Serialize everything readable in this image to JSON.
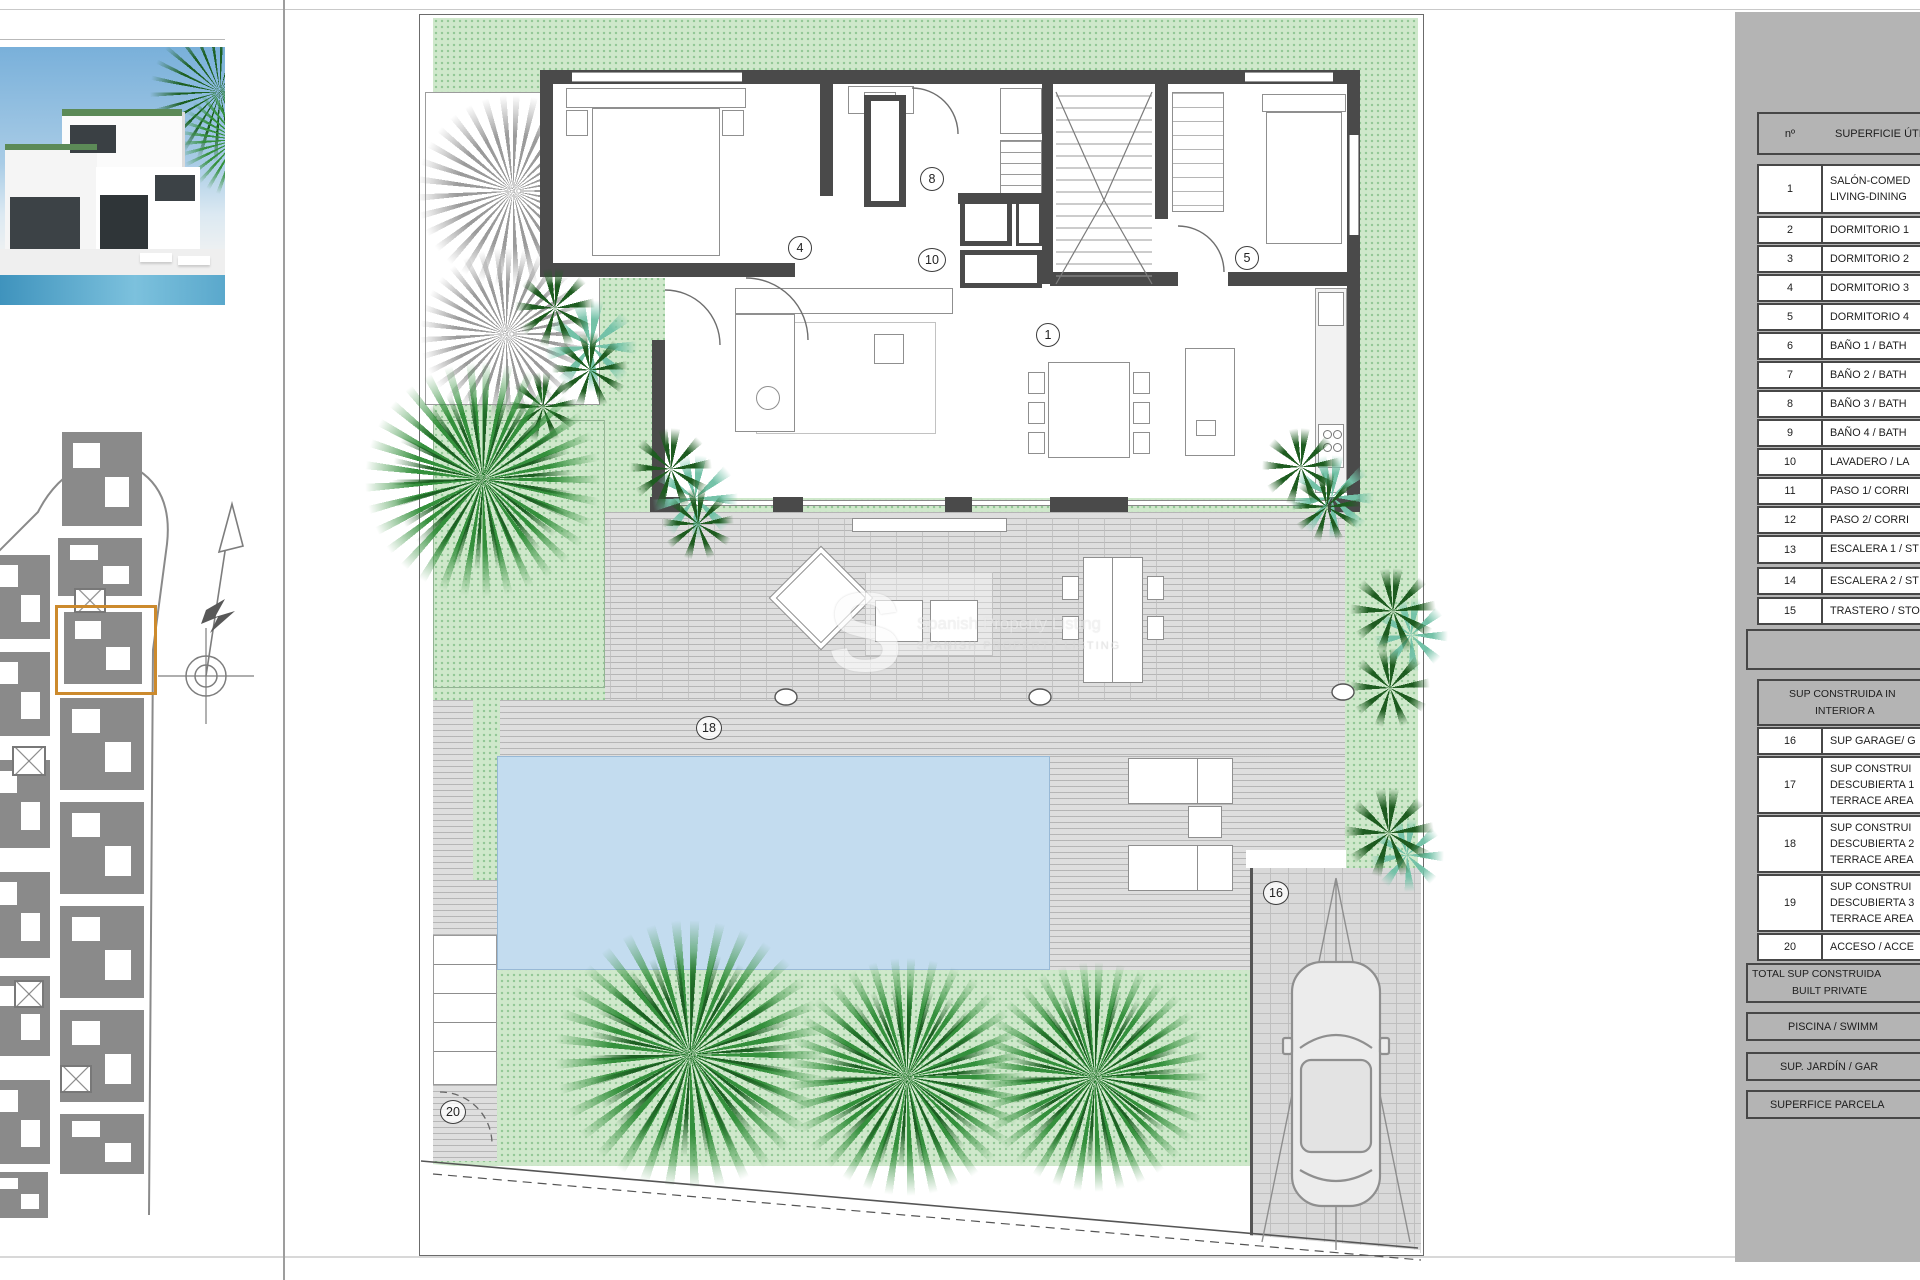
{
  "plan": {
    "labels": {
      "living": "1",
      "bedroom3": "4",
      "bedroom4": "5",
      "bathroom": "8",
      "laundry_hall": "10",
      "garage": "16",
      "terrace": "18",
      "access": "20"
    },
    "watermark": {
      "letter": "S",
      "line1": "Spanish Property Listing",
      "line2": "SPANISH PROPERTY LISTING"
    }
  },
  "panel": {
    "useful_table": {
      "col_num": "nº",
      "col_label": "SUPERFICIE ÚTI",
      "rows": [
        {
          "num": "1",
          "lines": [
            "SALÓN-COMED",
            "LIVING-DINING"
          ]
        },
        {
          "num": "2",
          "lines": [
            "DORMITORIO 1"
          ]
        },
        {
          "num": "3",
          "lines": [
            "DORMITORIO 2"
          ]
        },
        {
          "num": "4",
          "lines": [
            "DORMITORIO 3"
          ]
        },
        {
          "num": "5",
          "lines": [
            "DORMITORIO 4"
          ]
        },
        {
          "num": "6",
          "lines": [
            "BAÑO 1 / BATH"
          ]
        },
        {
          "num": "7",
          "lines": [
            "BAÑO 2 / BATH"
          ]
        },
        {
          "num": "8",
          "lines": [
            "BAÑO 3 / BATH"
          ]
        },
        {
          "num": "9",
          "lines": [
            "BAÑO 4 / BATH"
          ]
        },
        {
          "num": "10",
          "lines": [
            "LAVADERO / LA"
          ]
        },
        {
          "num": "11",
          "lines": [
            "PASO 1/ CORRI"
          ]
        },
        {
          "num": "12",
          "lines": [
            "PASO 2/ CORRI"
          ]
        },
        {
          "num": "13",
          "lines": [
            "ESCALERA 1 / ST"
          ]
        },
        {
          "num": "14",
          "lines": [
            "ESCALERA 2 / ST"
          ]
        },
        {
          "num": "15",
          "lines": [
            "TRASTERO / STO"
          ]
        }
      ]
    },
    "built_table": {
      "header_line1": "SUP CONSTRUIDA IN",
      "header_line2": "INTERIOR A",
      "rows": [
        {
          "num": "16",
          "lines": [
            "SUP GARAGE/ G"
          ]
        },
        {
          "num": "17",
          "lines": [
            "SUP CONSTRUI",
            "DESCUBIERTA 1",
            "TERRACE AREA"
          ]
        },
        {
          "num": "18",
          "lines": [
            "SUP CONSTRUI",
            "DESCUBIERTA 2",
            "TERRACE AREA"
          ]
        },
        {
          "num": "19",
          "lines": [
            "SUP CONSTRUI",
            "DESCUBIERTA 3",
            "TERRACE AREA"
          ]
        },
        {
          "num": "20",
          "lines": [
            "ACCESO / ACCE"
          ]
        }
      ],
      "total_line1": "TOTAL SUP CONSTRUIDA",
      "total_line2": "BUILT PRIVATE"
    },
    "summary_boxes": {
      "pool": "PISCINA / SWIMM",
      "garden": "SUP. JARDÍN / GAR",
      "parcel": "SUPERFICE PARCELA"
    }
  }
}
